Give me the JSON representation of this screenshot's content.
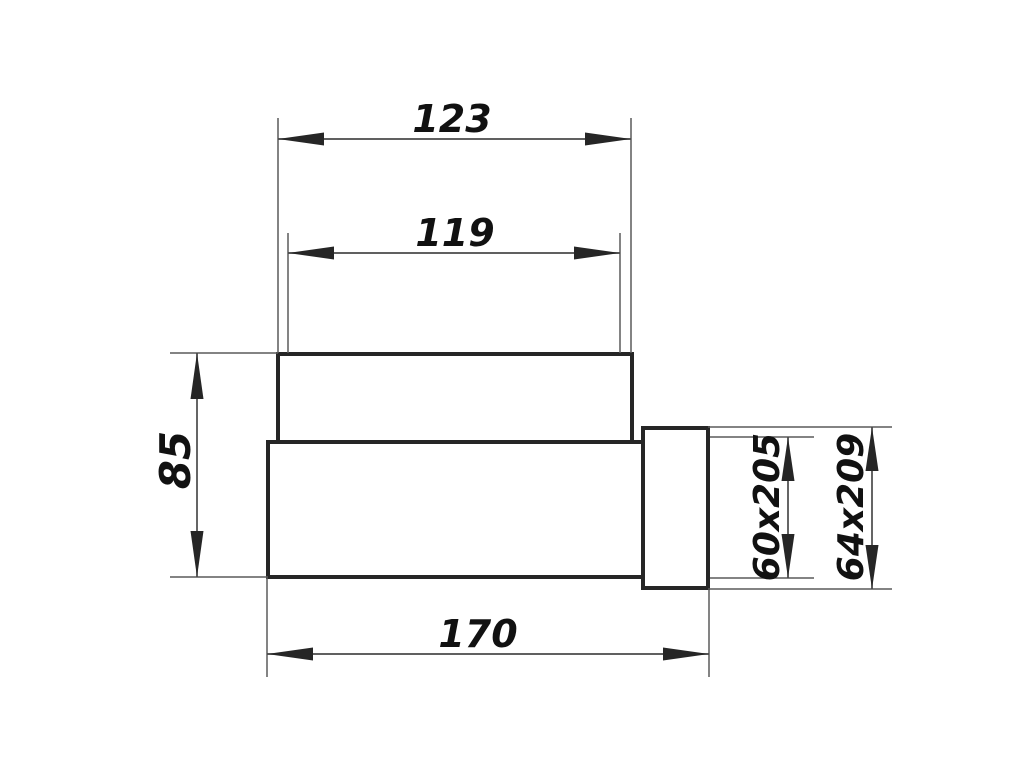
{
  "drawing": {
    "type": "technical-dimension-drawing",
    "background_color": "#ffffff",
    "outline_color": "#262626",
    "dimension_line_color": "#4a4a4a",
    "text_color": "#111111",
    "labels": {
      "width_top_outer": "123",
      "width_top_inner": "119",
      "height_left": "85",
      "width_bottom": "170",
      "spigot_inner": "60x205",
      "spigot_outer": "64x209"
    }
  }
}
